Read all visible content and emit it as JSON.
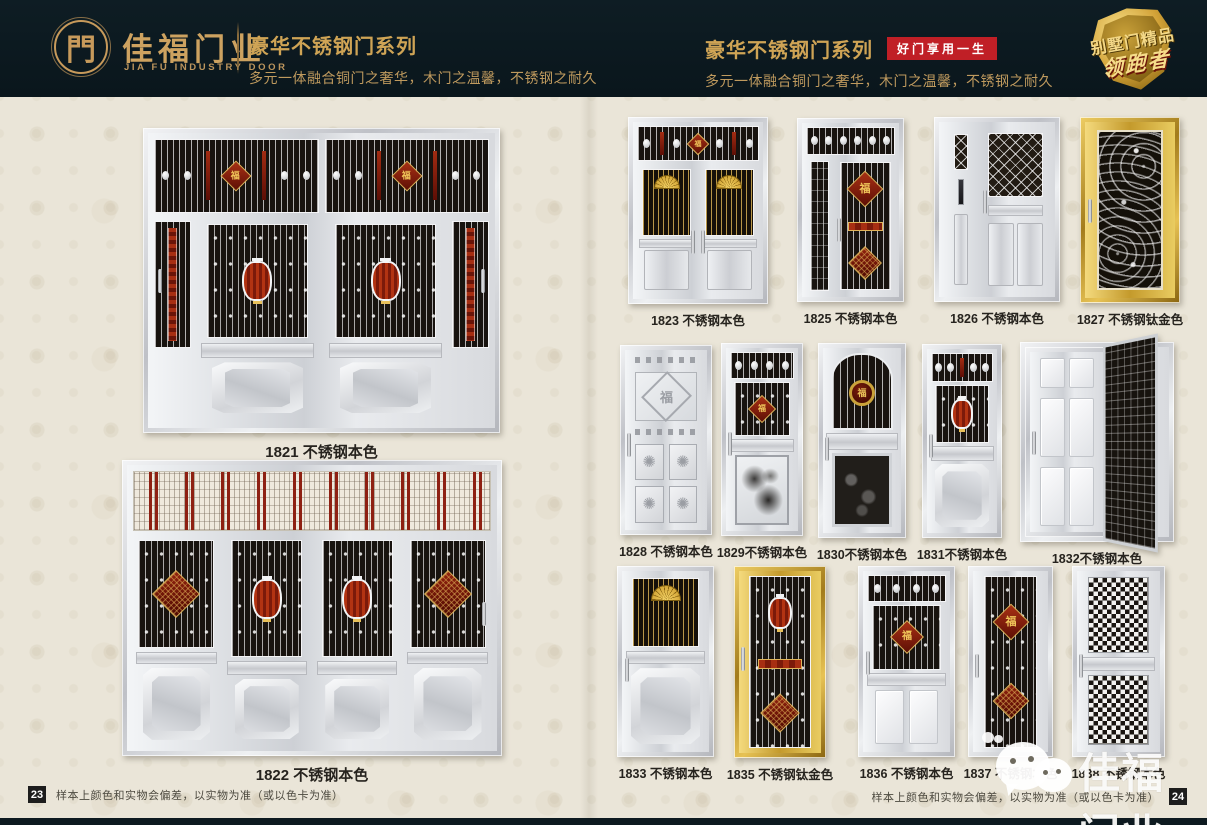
{
  "header": {
    "logo_glyph": "門",
    "company_cn": "佳福门业",
    "company_en": "JIA FU INDUSTRY DOOR",
    "left_section": {
      "series_title": "豪华不锈钢门系列",
      "tagline": "多元一体融合铜门之奢华，木门之温馨，不锈钢之耐久"
    },
    "right_section": {
      "series_title": "豪华不锈钢门系列",
      "badge": "好门享用一生",
      "tagline": "多元一体融合铜门之奢华，木门之温馨，不锈钢之耐久"
    },
    "emblem": {
      "line1": "别墅门精品",
      "line2": "领跑者"
    }
  },
  "decor": {
    "fu": "福"
  },
  "doors": [
    {
      "id": "1821",
      "label": "1821 不锈钢本色",
      "finish": "silver",
      "variant": "v1821"
    },
    {
      "id": "1822",
      "label": "1822 不锈钢本色",
      "finish": "silver",
      "variant": "v1822"
    },
    {
      "id": "1823",
      "label": "1823 不锈钢本色",
      "finish": "silver",
      "variant": "v1823"
    },
    {
      "id": "1825",
      "label": "1825 不锈钢本色",
      "finish": "silver",
      "variant": "v1825"
    },
    {
      "id": "1826",
      "label": "1826 不锈钢本色",
      "finish": "silver",
      "variant": "v1826"
    },
    {
      "id": "1827",
      "label": "1827 不锈钢钛金色",
      "finish": "gold",
      "variant": "v1827"
    },
    {
      "id": "1828",
      "label": "1828 不锈钢本色",
      "finish": "silver",
      "variant": "v1828"
    },
    {
      "id": "1829",
      "label": "1829不锈钢本色",
      "finish": "silver",
      "variant": "v1829"
    },
    {
      "id": "1830",
      "label": "1830不锈钢本色",
      "finish": "silver",
      "variant": "v1830"
    },
    {
      "id": "1831",
      "label": "1831不锈钢本色",
      "finish": "silver",
      "variant": "v1831"
    },
    {
      "id": "1832",
      "label": "1832不锈钢本色",
      "finish": "silver",
      "variant": "v1832"
    },
    {
      "id": "1833",
      "label": "1833 不锈钢本色",
      "finish": "silver",
      "variant": "v1833"
    },
    {
      "id": "1835",
      "label": "1835 不锈钢钛金色",
      "finish": "gold",
      "variant": "v1835"
    },
    {
      "id": "1836",
      "label": "1836 不锈钢本色",
      "finish": "silver",
      "variant": "v1836"
    },
    {
      "id": "1837",
      "label": "1837 不锈钢本色",
      "finish": "silver",
      "variant": "v1837"
    },
    {
      "id": "1838",
      "label": "1838 不锈钢本色",
      "finish": "silver",
      "variant": "v1838"
    }
  ],
  "footer": {
    "left_page_number": "23",
    "right_page_number": "24",
    "disclaimer": "样本上颜色和实物会偏差，以实物为准（或以色卡为准）"
  },
  "watermark": {
    "text": "佳福门业"
  },
  "colors": {
    "header_bg": "#0c1920",
    "accent_gold": "#cfa455",
    "badge_red": "#c01f26",
    "page_bg": "#eae5d8",
    "grille_dark": "#18130f",
    "ornament_red": "#8e2012"
  }
}
